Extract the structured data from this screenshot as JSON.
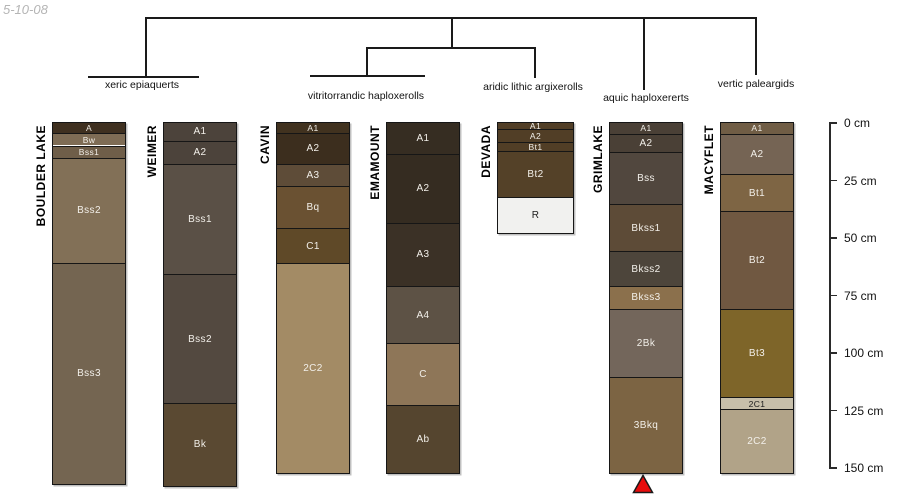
{
  "figure": {
    "date_label": "5-10-08",
    "background": "#ffffff",
    "line_color": "#1a1a1a"
  },
  "classification_tree": {
    "labels": [
      {
        "text": "xeric epiaquerts",
        "cx": 142,
        "top": 79
      },
      {
        "text": "vitritorrandic haploxerolls",
        "cx": 366,
        "top": 90
      },
      {
        "text": "aridic lithic argixerolls",
        "cx": 533,
        "top": 81
      },
      {
        "text": "aquic haploxererts",
        "cx": 646,
        "top": 92
      },
      {
        "text": "vertic paleargids",
        "cx": 756,
        "top": 78
      }
    ],
    "segments": [
      [
        145,
        17,
        755,
        17
      ],
      [
        145,
        17,
        145,
        76
      ],
      [
        88,
        76,
        197,
        76
      ],
      [
        451,
        17,
        451,
        47
      ],
      [
        366,
        47,
        534,
        47
      ],
      [
        366,
        47,
        366,
        75
      ],
      [
        310,
        75,
        423,
        75
      ],
      [
        534,
        47,
        534,
        78
      ],
      [
        643,
        17,
        643,
        90
      ],
      [
        755,
        17,
        755,
        75
      ]
    ]
  },
  "depth_scale": {
    "axis_x": 829,
    "zero_y": 123,
    "px_per_cm": 2.3,
    "tick_length": 8,
    "ticks": [
      {
        "cm": 0,
        "label": "0 cm"
      },
      {
        "cm": 25,
        "label": "25 cm"
      },
      {
        "cm": 50,
        "label": "50 cm"
      },
      {
        "cm": 75,
        "label": "75 cm"
      },
      {
        "cm": 100,
        "label": "100 cm"
      },
      {
        "cm": 125,
        "label": "125 cm"
      },
      {
        "cm": 150,
        "label": "150 cm"
      }
    ]
  },
  "profiles": [
    {
      "name": "BOULDER LAKE",
      "x": 52,
      "width": 72,
      "group": "xeric epiaquerts",
      "horizons": [
        {
          "label": "A",
          "top_cm": 0,
          "bottom_cm": 4.5,
          "color": "#3f3020"
        },
        {
          "label": "Bw",
          "top_cm": 4.5,
          "bottom_cm": 10,
          "color": "#7e6c55"
        },
        {
          "label": "Bss1",
          "top_cm": 10,
          "bottom_cm": 15.5,
          "color": "#6f5e49"
        },
        {
          "label": "Bss2",
          "top_cm": 15.5,
          "bottom_cm": 61,
          "color": "#827057"
        },
        {
          "label": "Bss3",
          "top_cm": 61,
          "bottom_cm": 157,
          "color": "#746551"
        }
      ]
    },
    {
      "name": "WEIMER",
      "x": 163,
      "width": 72,
      "group": "xeric epiaquerts",
      "horizons": [
        {
          "label": "A1",
          "top_cm": 0,
          "bottom_cm": 8,
          "color": "#4c433b"
        },
        {
          "label": "A2",
          "top_cm": 8,
          "bottom_cm": 18,
          "color": "#4c433b"
        },
        {
          "label": "Bss1",
          "top_cm": 18,
          "bottom_cm": 66,
          "color": "#5a5046"
        },
        {
          "label": "Bss2",
          "top_cm": 66,
          "bottom_cm": 122,
          "color": "#534940"
        },
        {
          "label": "Bk",
          "top_cm": 122,
          "bottom_cm": 158,
          "color": "#5a4932"
        }
      ]
    },
    {
      "name": "CAVIN",
      "x": 276,
      "width": 72,
      "group": "vitritorrandic haploxerolls",
      "horizons": [
        {
          "label": "A1",
          "top_cm": 0,
          "bottom_cm": 4.5,
          "color": "#41321f"
        },
        {
          "label": "A2",
          "top_cm": 4.5,
          "bottom_cm": 18,
          "color": "#3c2e1e"
        },
        {
          "label": "A3",
          "top_cm": 18,
          "bottom_cm": 27.5,
          "color": "#5e4c38"
        },
        {
          "label": "Bq",
          "top_cm": 27.5,
          "bottom_cm": 46,
          "color": "#6a5132"
        },
        {
          "label": "C1",
          "top_cm": 46,
          "bottom_cm": 61,
          "color": "#5f4928"
        },
        {
          "label": "2C2",
          "top_cm": 61,
          "bottom_cm": 152.5,
          "color": "#a38b65"
        }
      ]
    },
    {
      "name": "EMAMOUNT",
      "x": 386,
      "width": 72,
      "group": "vitritorrandic haploxerolls",
      "horizons": [
        {
          "label": "A1",
          "top_cm": 0,
          "bottom_cm": 13.5,
          "color": "#362d22"
        },
        {
          "label": "A2",
          "top_cm": 13.5,
          "bottom_cm": 43.5,
          "color": "#352c21"
        },
        {
          "label": "A3",
          "top_cm": 43.5,
          "bottom_cm": 71,
          "color": "#3b3126"
        },
        {
          "label": "A4",
          "top_cm": 71,
          "bottom_cm": 96,
          "color": "#5d5245"
        },
        {
          "label": "C",
          "top_cm": 96,
          "bottom_cm": 123,
          "color": "#8e7658"
        },
        {
          "label": "Ab",
          "top_cm": 123,
          "bottom_cm": 152.5,
          "color": "#55452f"
        }
      ]
    },
    {
      "name": "DEVADA",
      "x": 497,
      "width": 75,
      "group": "aridic lithic argixerolls",
      "horizons": [
        {
          "label": "A1",
          "top_cm": 0,
          "bottom_cm": 3,
          "color": "#513e26"
        },
        {
          "label": "A2",
          "top_cm": 3,
          "bottom_cm": 8.5,
          "color": "#513e26"
        },
        {
          "label": "Bt1",
          "top_cm": 8.5,
          "bottom_cm": 12.5,
          "color": "#513e26"
        },
        {
          "label": "Bt2",
          "top_cm": 12.5,
          "bottom_cm": 32.5,
          "color": "#544128"
        },
        {
          "label": "R",
          "top_cm": 32.5,
          "bottom_cm": 48,
          "color": "#f1f1ef",
          "text": "dark"
        }
      ]
    },
    {
      "name": "GRIMLAKE",
      "x": 609,
      "width": 72,
      "group": "aquic haploxererts",
      "marker": "red-triangle",
      "horizons": [
        {
          "label": "A1",
          "top_cm": 0,
          "bottom_cm": 5,
          "color": "#4a4036"
        },
        {
          "label": "A2",
          "top_cm": 5,
          "bottom_cm": 13,
          "color": "#4a4036"
        },
        {
          "label": "Bss",
          "top_cm": 13,
          "bottom_cm": 35.5,
          "color": "#51473e"
        },
        {
          "label": "Bkss1",
          "top_cm": 35.5,
          "bottom_cm": 56,
          "color": "#5d4b37"
        },
        {
          "label": "Bkss2",
          "top_cm": 56,
          "bottom_cm": 71,
          "color": "#4d453b"
        },
        {
          "label": "Bkss3",
          "top_cm": 71,
          "bottom_cm": 81,
          "color": "#8b704c"
        },
        {
          "label": "2Bk",
          "top_cm": 81,
          "bottom_cm": 110.5,
          "color": "#73665b"
        },
        {
          "label": "3Bkq",
          "top_cm": 110.5,
          "bottom_cm": 152.5,
          "color": "#7c6443"
        }
      ]
    },
    {
      "name": "MACYFLET",
      "x": 720,
      "width": 72,
      "group": "vertic paleargids",
      "horizons": [
        {
          "label": "A1",
          "top_cm": 0,
          "bottom_cm": 5,
          "color": "#705d45"
        },
        {
          "label": "A2",
          "top_cm": 5,
          "bottom_cm": 22.5,
          "color": "#756454"
        },
        {
          "label": "Bt1",
          "top_cm": 22.5,
          "bottom_cm": 38.5,
          "color": "#7e6544"
        },
        {
          "label": "Bt2",
          "top_cm": 38.5,
          "bottom_cm": 81,
          "color": "#705841"
        },
        {
          "label": "Bt3",
          "top_cm": 81,
          "bottom_cm": 119.5,
          "color": "#7e6529"
        },
        {
          "label": "2C1",
          "top_cm": 119.5,
          "bottom_cm": 124.5,
          "color": "#c7bfaa",
          "text": "dark"
        },
        {
          "label": "2C2",
          "top_cm": 124.5,
          "bottom_cm": 152.5,
          "color": "#b1a388"
        }
      ]
    }
  ],
  "marker": {
    "shape": "triangle-up",
    "color": "#e80c0c",
    "outline": "#1a1a1a",
    "cx": 643,
    "top": 474,
    "width": 22,
    "height": 20
  }
}
